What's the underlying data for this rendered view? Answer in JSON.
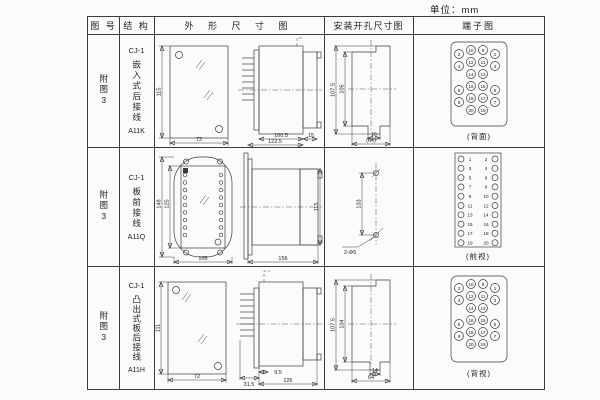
{
  "unit_label": "单位：mm",
  "table": {
    "headers": {
      "fig_no": "图 号",
      "structure": "结 构",
      "outline": "外 形 尺 寸 图",
      "mounting": "安装开孔尺寸图",
      "terminal": "端子图"
    }
  },
  "rows": [
    {
      "fig_no": "附图3",
      "model": "CJ-1",
      "structure": "嵌入式后接线",
      "code": "A11K",
      "outline": {
        "height": "115",
        "width": "72",
        "d1": "100.5",
        "d2": "122.5",
        "d3": "15"
      },
      "mounting": {
        "v1": "107.5",
        "v2": "105",
        "h1": "16",
        "h2": "(64)"
      },
      "terminal_caption": "(背面)",
      "terminals": [
        "2",
        "10",
        "9",
        "1",
        "4",
        "12",
        "11",
        "3",
        "14",
        "13",
        "6",
        "16",
        "15",
        "5",
        "8",
        "18",
        "17",
        "7",
        "20",
        "19"
      ]
    },
    {
      "fig_no": "附图3",
      "model": "CJ-1",
      "structure": "板前接线",
      "code": "A11Q",
      "outline": {
        "h_outer": "148",
        "h_inner": "125",
        "width": "105",
        "depth": "156",
        "side_h": "115"
      },
      "mounting": {
        "v": "133",
        "hole": "2-Φ5"
      },
      "terminal_caption": "(前视)",
      "terminals_left": [
        "1",
        "3",
        "5",
        "7",
        "9",
        "11",
        "13",
        "15",
        "17",
        "19"
      ],
      "terminals_right": [
        "2",
        "4",
        "6",
        "8",
        "10",
        "12",
        "14",
        "16",
        "18",
        "20"
      ]
    },
    {
      "fig_no": "附图3",
      "model": "CJ-1",
      "structure": "凸出式板后接线",
      "code": "A11H",
      "outline": {
        "height": "111",
        "width": "72",
        "d1": "31.5",
        "d2": "9.5",
        "d3": "126"
      },
      "mounting": {
        "v1": "107.5",
        "v2": "104",
        "h1": "14",
        "h2": "64"
      },
      "terminal_caption": "(背视)",
      "terminals": [
        "2",
        "10",
        "9",
        "1",
        "4",
        "12",
        "11",
        "3",
        "14",
        "13",
        "6",
        "16",
        "15",
        "5",
        "8",
        "18",
        "17",
        "7",
        "20",
        "19"
      ]
    }
  ]
}
